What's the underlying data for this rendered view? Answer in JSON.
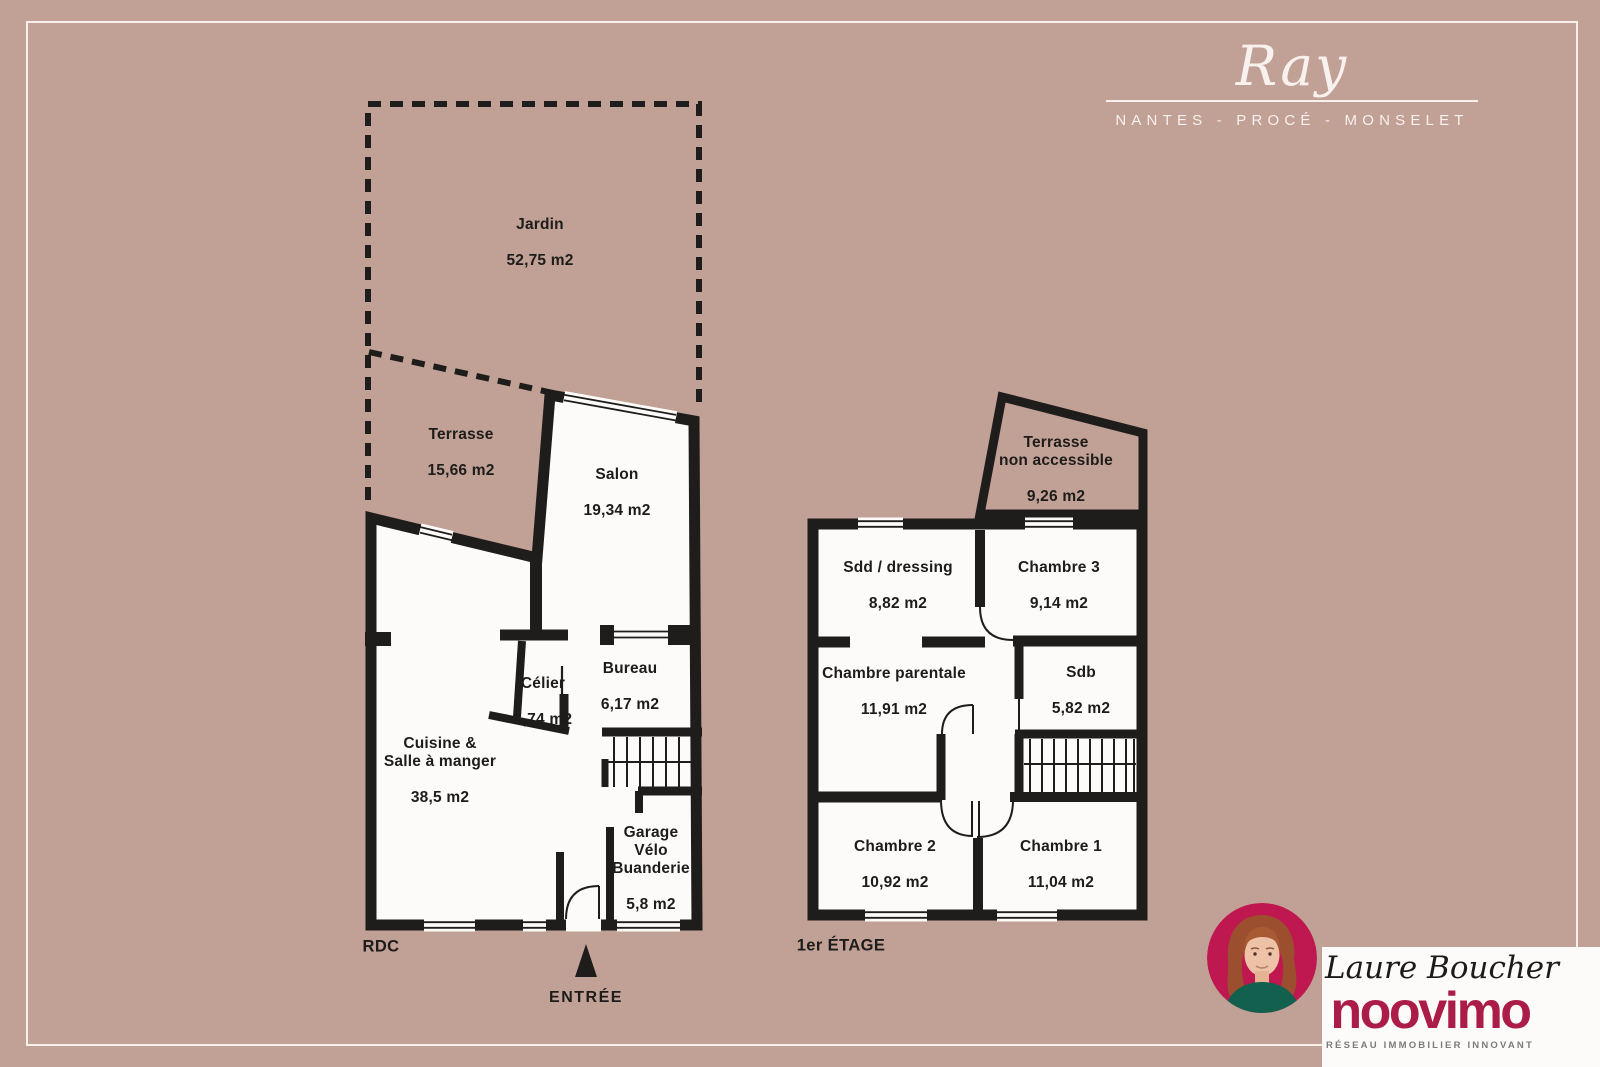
{
  "header": {
    "brand": "Ray",
    "location": "NANTES - PROCÉ - MONSELET"
  },
  "plans": {
    "rdc": {
      "floor_label": "RDC",
      "entrance_label": "ENTRÉE",
      "rooms": [
        {
          "id": "jardin",
          "name": "Jardin",
          "area": "52,75 m2"
        },
        {
          "id": "terrasse",
          "name": "Terrasse",
          "area": "15,66 m2"
        },
        {
          "id": "salon",
          "name": "Salon",
          "area": "19,34 m2"
        },
        {
          "id": "celier",
          "name": "Célier",
          "area": "1,74 m2"
        },
        {
          "id": "bureau",
          "name": "Bureau",
          "area": "6,17 m2"
        },
        {
          "id": "cuisine",
          "name": "Cuisine &\nSalle à manger",
          "area": "38,5 m2"
        },
        {
          "id": "garage",
          "name": "Garage\nVélo\nBuanderie",
          "area": "5,8 m2"
        }
      ]
    },
    "etage": {
      "floor_label": "1er ÉTAGE",
      "rooms": [
        {
          "id": "terrasse-na",
          "name": "Terrasse\nnon accessible",
          "area": "9,26 m2"
        },
        {
          "id": "sdd",
          "name": "Sdd / dressing",
          "area": "8,82 m2"
        },
        {
          "id": "chambre3",
          "name": "Chambre 3",
          "area": "9,14 m2"
        },
        {
          "id": "parentale",
          "name": "Chambre parentale",
          "area": "11,91 m2"
        },
        {
          "id": "sdb",
          "name": "Sdb",
          "area": "5,82 m2"
        },
        {
          "id": "chambre2",
          "name": "Chambre 2",
          "area": "10,92 m2"
        },
        {
          "id": "chambre1",
          "name": "Chambre 1",
          "area": "11,04 m2"
        }
      ]
    }
  },
  "agent": {
    "name": "Laure Boucher",
    "brand": "noovimo",
    "tagline": "RÉSEAU IMMOBILIER INNOVANT"
  },
  "colors": {
    "background": "#c1a096",
    "wall": "#1e1d1b",
    "room_fill": "#fcfbf9",
    "brand_red": "#ab1c48",
    "photo_background": "#bf1750",
    "frame_white": "#f7f0ec"
  }
}
